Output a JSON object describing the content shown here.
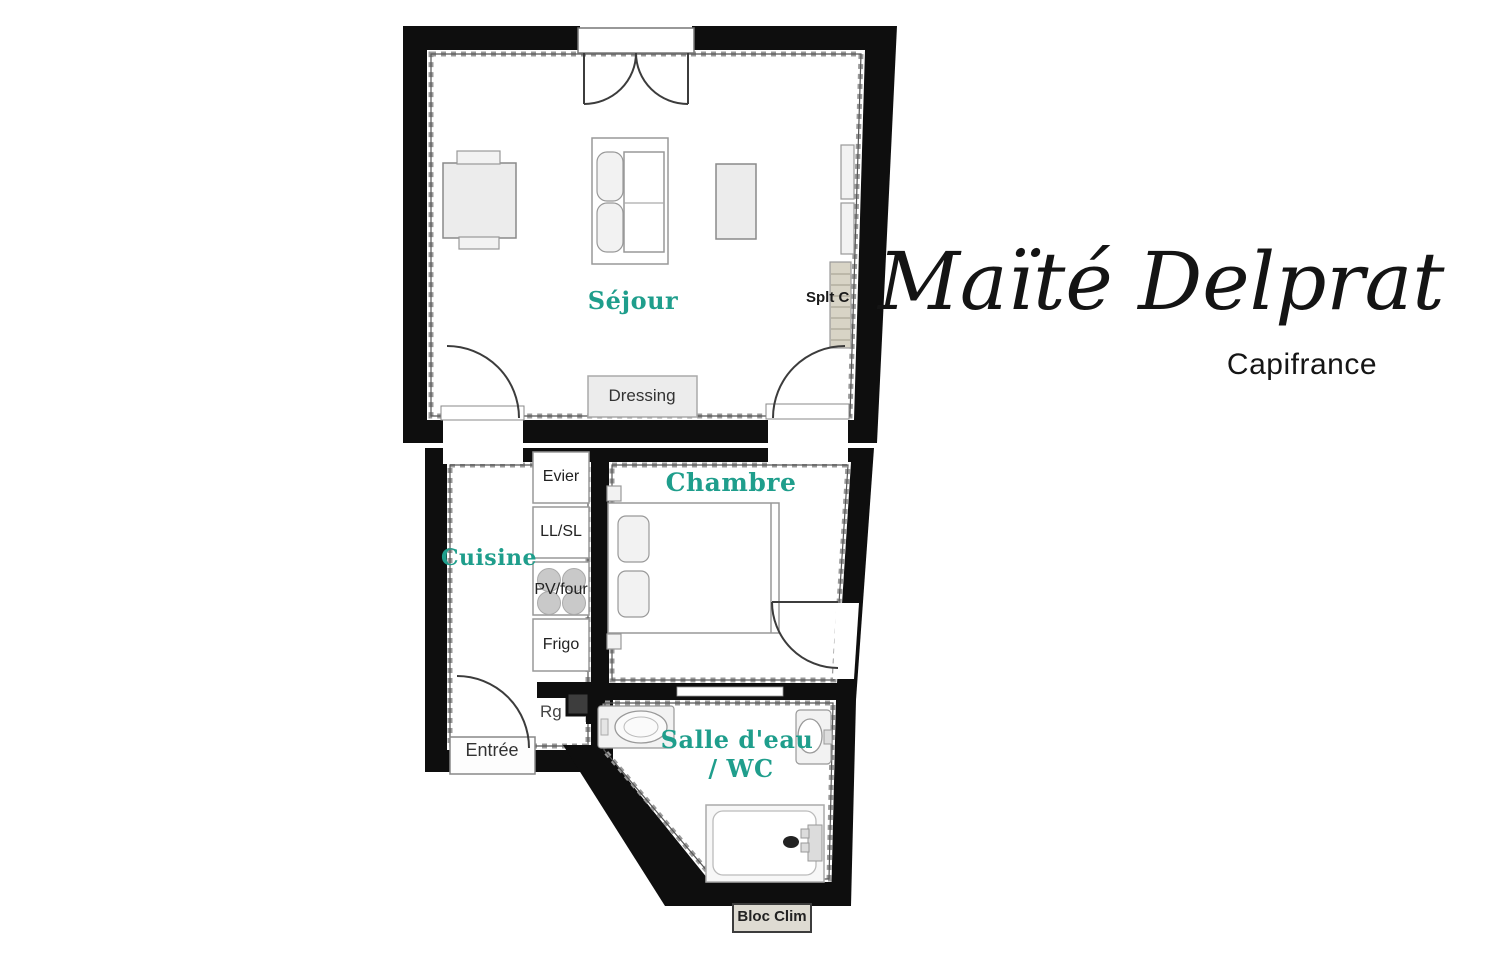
{
  "branding": {
    "agent_name": "Maïté Delprat",
    "agency": "Capifrance"
  },
  "rooms": {
    "sejour": {
      "label": "Séjour"
    },
    "cuisine": {
      "label": "Cuisine"
    },
    "chambre": {
      "label": "Chambre"
    },
    "salle_eau": {
      "label": "Salle d'eau",
      "label_wc": "/ WC"
    }
  },
  "fixtures": {
    "dressing": "Dressing",
    "evier": "Evier",
    "lave_linge": "LL/SL",
    "plaque_four": "PV/four",
    "frigo": "Frigo",
    "rangement": "Rg",
    "entree": "Entrée",
    "split_clim": "Splt C",
    "bloc_clim": "Bloc Clim"
  },
  "colors": {
    "room_label_teal": "#1f9e8c",
    "wall_black": "#0e0e0e",
    "unit_beige": "#d8d4c6"
  }
}
